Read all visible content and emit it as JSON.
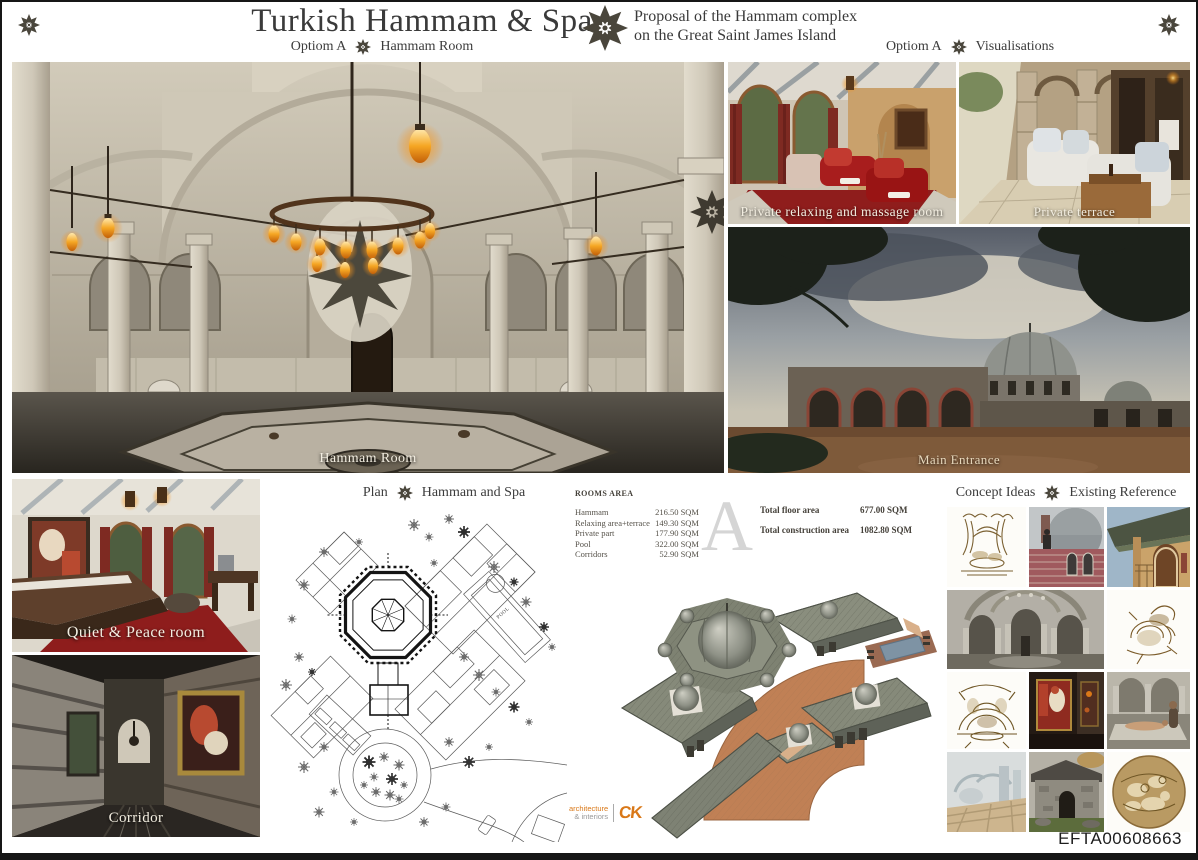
{
  "board": {
    "title": "Turkish Hammam & Spa",
    "subtitle": [
      "Proposal of the Hammam complex",
      "on the Great Saint James Island"
    ],
    "sheet_code": "EFTA00608663"
  },
  "section_headers": {
    "hammam_room": {
      "option": "Optiom A",
      "name": "Hammam Room"
    },
    "visualisations": {
      "option": "Optiom A",
      "name": "Visualisations"
    },
    "plan": {
      "left": "Plan",
      "right": "Hammam and Spa"
    },
    "concept": {
      "left": "Concept Ideas",
      "right": "Existing Reference"
    }
  },
  "captions": {
    "hammam_room": "Hammam Room",
    "private_relaxing": "Private relaxing and massage room",
    "private_terrace": "Private terrace",
    "main_entrance": "Main  Entrance",
    "quiet_peace": "Quiet & Peace room",
    "corridor": "Corridor"
  },
  "rooms_area": {
    "title": "ROOMS AREA",
    "rows": [
      {
        "name": "Hammam",
        "value": "216.50 SQM"
      },
      {
        "name": "Relaxing area+terrace",
        "value": "149.30 SQM"
      },
      {
        "name": "Private part",
        "value": "177.90 SQM"
      },
      {
        "name": "Pool",
        "value": "322.00 SQM"
      },
      {
        "name": "Corridors",
        "value": "52.90 SQM"
      },
      {
        "name": "Staff+technical part",
        "value": "90.40 SQM"
      },
      {
        "name": "Steam room",
        "value": "36.90 SQM"
      },
      {
        "name": "Entrance",
        "value": "36.90 SQM"
      }
    ],
    "option_letter": "A",
    "totals": [
      {
        "name": "Total floor area",
        "value": "677.00 SQM"
      },
      {
        "name": "Total construction area",
        "value": "1082.80 SQM"
      }
    ]
  },
  "plan_labels": {
    "pool": "POOL"
  },
  "logo": {
    "line1": "architecture",
    "line2": "& interiors",
    "mark": "CK"
  },
  "colors": {
    "accent_orange": "#d97818",
    "header_text": "#3c3c3c",
    "caption_text": "#f3eee1",
    "watermark_gray": "#d5d5d5",
    "lamp_orange": "#f5a623"
  }
}
